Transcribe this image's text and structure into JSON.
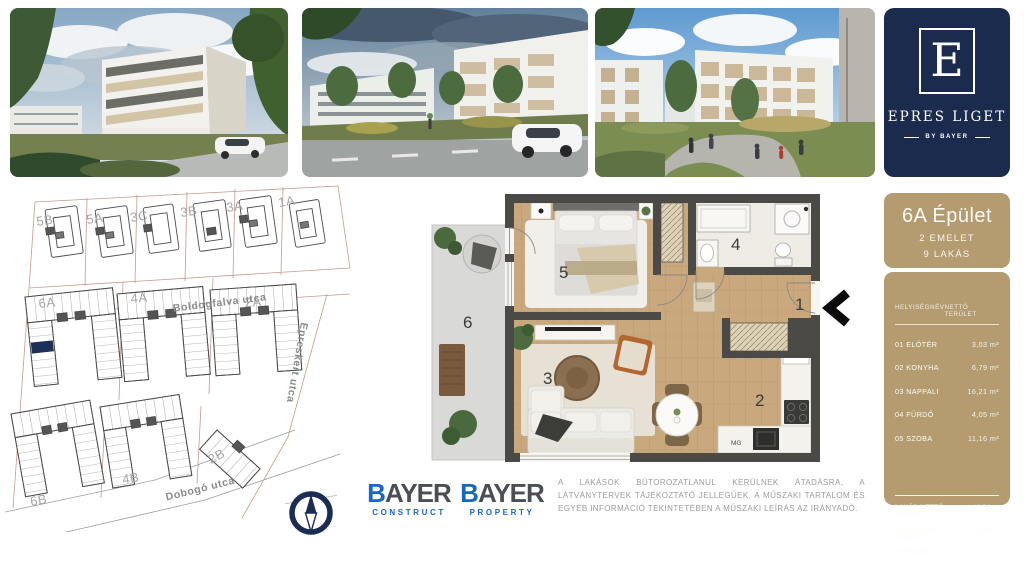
{
  "brand": {
    "letter": "E",
    "title": "EPRES LIGET",
    "subtitle": "BY BAYER",
    "navy": "#1b2b4d"
  },
  "building_panel": {
    "title": "6A Épület",
    "floors": "2 EMELET",
    "units": "9 LAKÁS",
    "tan": "#b49b70"
  },
  "area_table": {
    "col_room": "HELYISÉGNÉV",
    "col_area": "NETTÓ TERÜLET",
    "rows": [
      {
        "name": "01 ELŐTÉR",
        "area": "3,03 m²"
      },
      {
        "name": "02 KONYHA",
        "area": "6,79 m²"
      },
      {
        "name": "03 NAPPALI",
        "area": "16,21 m²"
      },
      {
        "name": "04 FÜRDŐ",
        "area": "4,05 m²"
      },
      {
        "name": "05 SZOBA",
        "area": "11,16 m²"
      }
    ],
    "summary": [
      {
        "name": "LAKÁS NETTÓ TERÜLET",
        "area": "41,24 m²"
      },
      {
        "name": "ÉRTÉKESÍTETT TERÜLET",
        "area": "44,48 m²"
      },
      {
        "name": "06 ERKÉLY",
        "area": "10,01 m²"
      }
    ]
  },
  "site_plan": {
    "top_row": [
      "5B",
      "5A",
      "3C",
      "3B",
      "3A",
      "1A"
    ],
    "mid_row": [
      "6A",
      "4A",
      "2A"
    ],
    "bottom_row": [
      "6B",
      "4B",
      "2B"
    ],
    "streets": [
      "Boldogfalva utca",
      "Epreskert utca",
      "Dobogó utca"
    ],
    "highlight_color": "#1d3157"
  },
  "floor_plan": {
    "room_numbers": [
      "1",
      "2",
      "3",
      "4",
      "5",
      "6"
    ],
    "appliance_label": "MG"
  },
  "footer": {
    "logos": [
      {
        "brand_initial": "B",
        "brand_rest": "AYER",
        "division": "CONSTRUCT"
      },
      {
        "brand_initial": "B",
        "brand_rest": "AYER",
        "division": "PROPERTY"
      }
    ],
    "disclaimer": "A LAKÁSOK BÚTOROZATLANUL KERÜLNEK ÁTADÁSRA, A LÁTVÁNYTERVEK TÁJÉKOZTATÓ JELLEGŰEK. A MŰSZAKI TARTALOM ÉS EGYÉB INFORMÁCIÓ TEKINTETÉBEN A MŰSZAKI LEÍRÁS AZ IRÁNYADÓ.",
    "bayer_blue": "#1767c5"
  }
}
